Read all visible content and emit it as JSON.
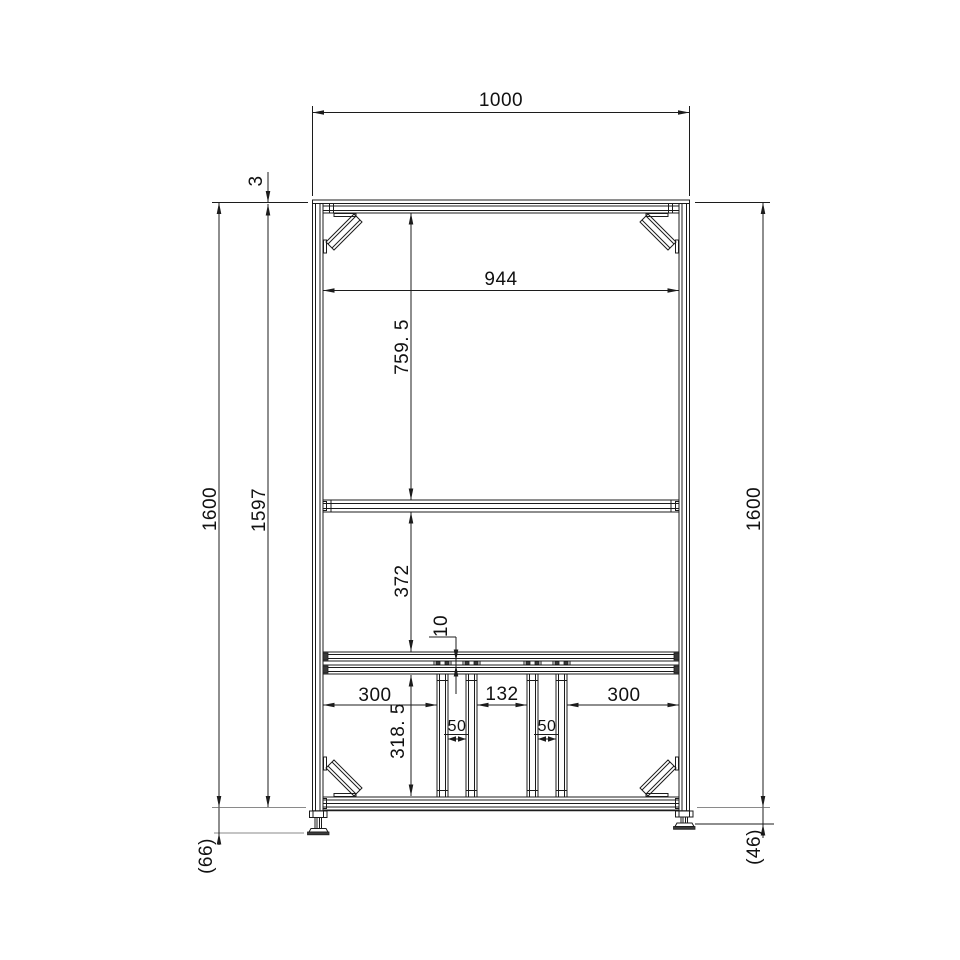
{
  "drawing": {
    "type": "technical-drawing",
    "view": "front-elevation-aluminum-frame-rack",
    "units": "mm",
    "dims": {
      "overall_width": "1000",
      "inner_width": "944",
      "plate_thickness": "3",
      "overall_height_left": "1600",
      "frame_height": "1597",
      "upper_bay": "759. 5",
      "middle_bay": "372",
      "rail_gap": "10",
      "span_left": "300",
      "span_center": "132",
      "span_right": "300",
      "gap_left": "50",
      "gap_right": "50",
      "lower_bay": "318. 5",
      "overall_height_right": "1600",
      "foot_left": "(66)",
      "foot_right": "(46)"
    },
    "colors": {
      "line": "#1c1c1c",
      "extension_line": "#8a8a8a",
      "background": "#ffffff"
    }
  }
}
